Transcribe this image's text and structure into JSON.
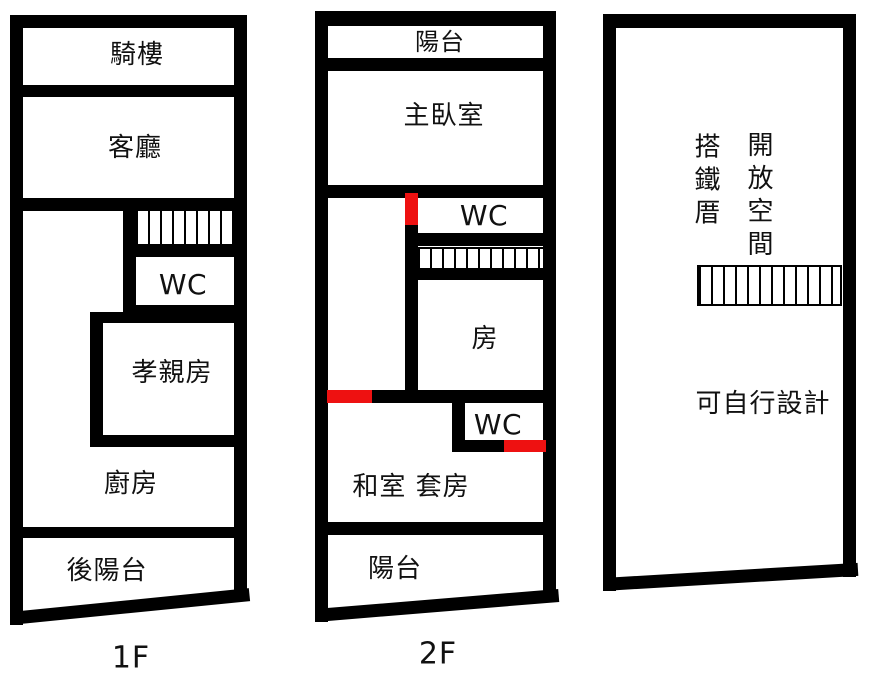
{
  "colors": {
    "wall": "#000000",
    "door_marker": "#ee1111",
    "text": "#111111",
    "background": "#ffffff"
  },
  "floors": [
    {
      "label": "1F",
      "rooms": {
        "arcade": "騎樓",
        "living_room": "客廳",
        "wc": "WC",
        "parents_room": "孝親房",
        "kitchen": "廚房",
        "back_balcony": "後陽台"
      }
    },
    {
      "label": "2F",
      "rooms": {
        "front_balcony": "陽台",
        "master_bedroom": "主臥室",
        "wc_upper": "WC",
        "room": "房",
        "wc_lower": "WC",
        "tatami_suite": "和室 套房",
        "rear_balcony": "陽台"
      }
    },
    {
      "rooms": {
        "iron_shed": "搭鐵厝",
        "open_space": "開放空間",
        "free_design": "可自行設計"
      }
    }
  ]
}
